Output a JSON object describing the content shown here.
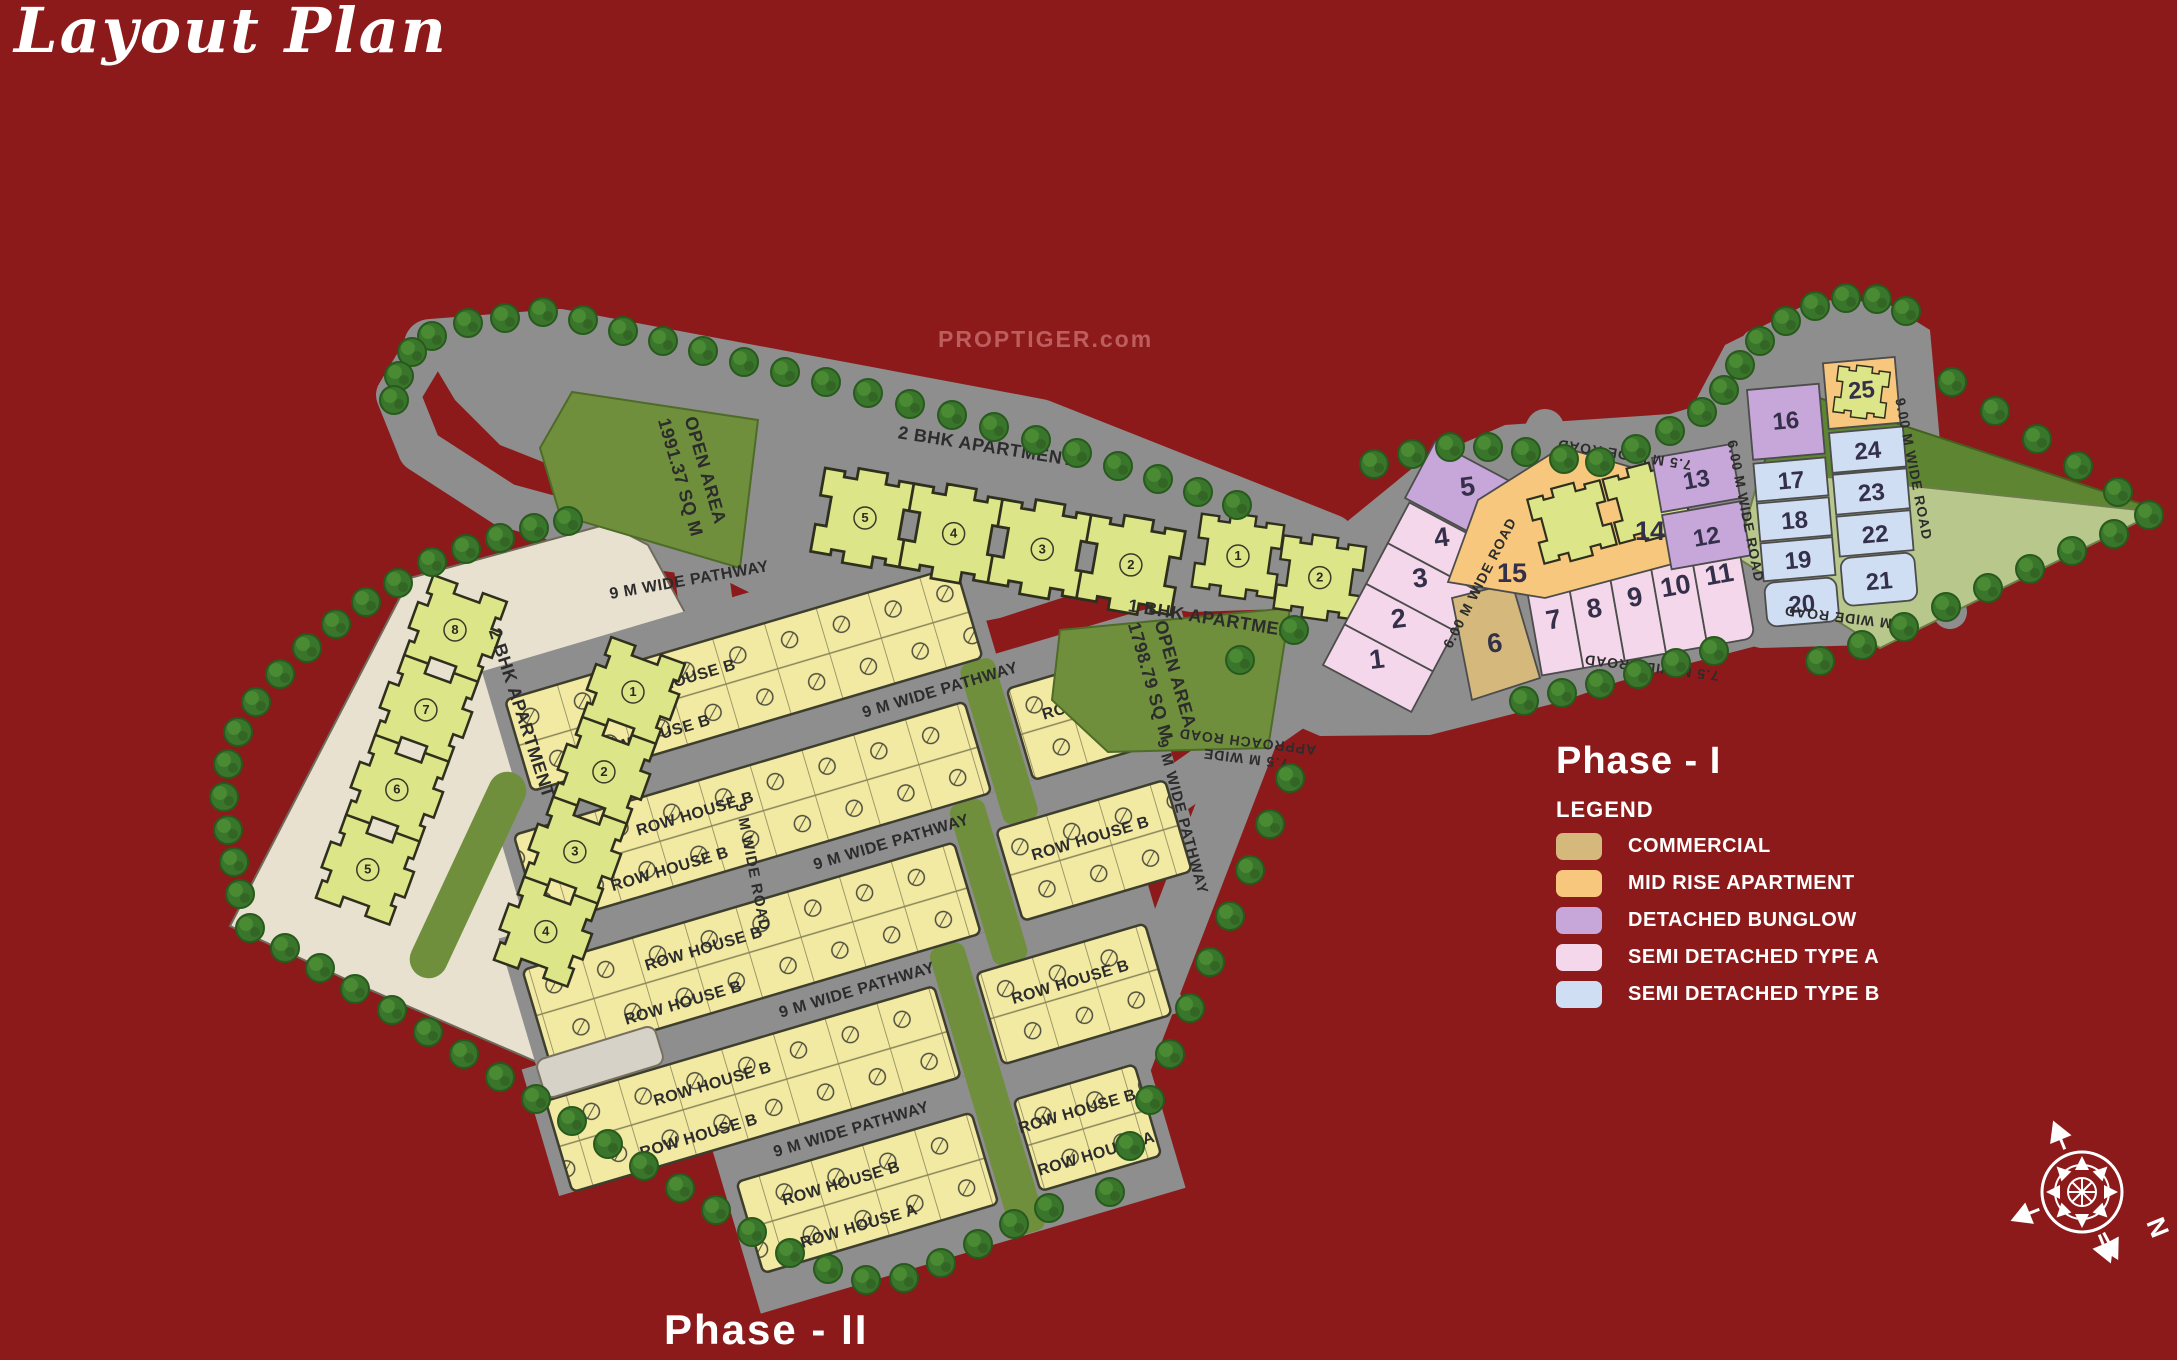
{
  "title": "Layout Plan",
  "watermark": "PROPTIGER.com",
  "phase1": {
    "heading": "Phase - I",
    "legend_title": "LEGEND",
    "legend": [
      {
        "label": "COMMERCIAL",
        "color": "#d5b87c"
      },
      {
        "label": "MID RISE APARTMENT",
        "color": "#f6c77d"
      },
      {
        "label": "DETACHED BUNGLOW",
        "color": "#c7a6da"
      },
      {
        "label": "SEMI DETACHED TYPE A",
        "color": "#f5d7eb"
      },
      {
        "label": "SEMI DETACHED TYPE B",
        "color": "#cfdef2"
      }
    ]
  },
  "phase2": {
    "heading": "Phase - II"
  },
  "areas": {
    "open1_line1": "OPEN AREA",
    "open1_line2": "1991.37 SQ M",
    "open2_line1": "OPEN AREA",
    "open2_line2": "1798.79 SQ M"
  },
  "buildings": {
    "apt2bhk": "2 BHK APARTMENT",
    "apt1bhk": "1 BHK APARTMENT"
  },
  "rows": {
    "a": "ROW HOUSE A",
    "b": "ROW HOUSE B"
  },
  "roads": {
    "pathway9": "9 M WIDE PATHWAY",
    "road9": "9 M WIDE ROAD",
    "road6": "6.00 M WIDE ROAD",
    "road900": "9.00 M WIDE ROAD",
    "road75": "7.5 M WIDE ROAD",
    "approach_line1": "7.5 M WIDE",
    "approach_line2": "APPROACH ROAD"
  },
  "compass": {
    "north": "N"
  },
  "plots": {
    "p1": "1",
    "p2": "2",
    "p3": "3",
    "p4": "4",
    "p5": "5",
    "p6": "6",
    "p7": "7",
    "p8": "8",
    "p9": "9",
    "p10": "10",
    "p11": "11",
    "p12": "12",
    "p13": "13",
    "p14": "14",
    "p15": "15",
    "p16": "16",
    "p17": "17",
    "p18": "18",
    "p19": "19",
    "p20": "20",
    "p21": "21",
    "p22": "22",
    "p23": "23",
    "p24": "24",
    "p25": "25"
  },
  "towers": {
    "left": [
      "8",
      "7",
      "6",
      "5"
    ],
    "right": [
      "1",
      "2",
      "3",
      "4"
    ],
    "central": [
      "5",
      "4",
      "3",
      "2"
    ],
    "onebhk": [
      "1",
      "2"
    ]
  }
}
